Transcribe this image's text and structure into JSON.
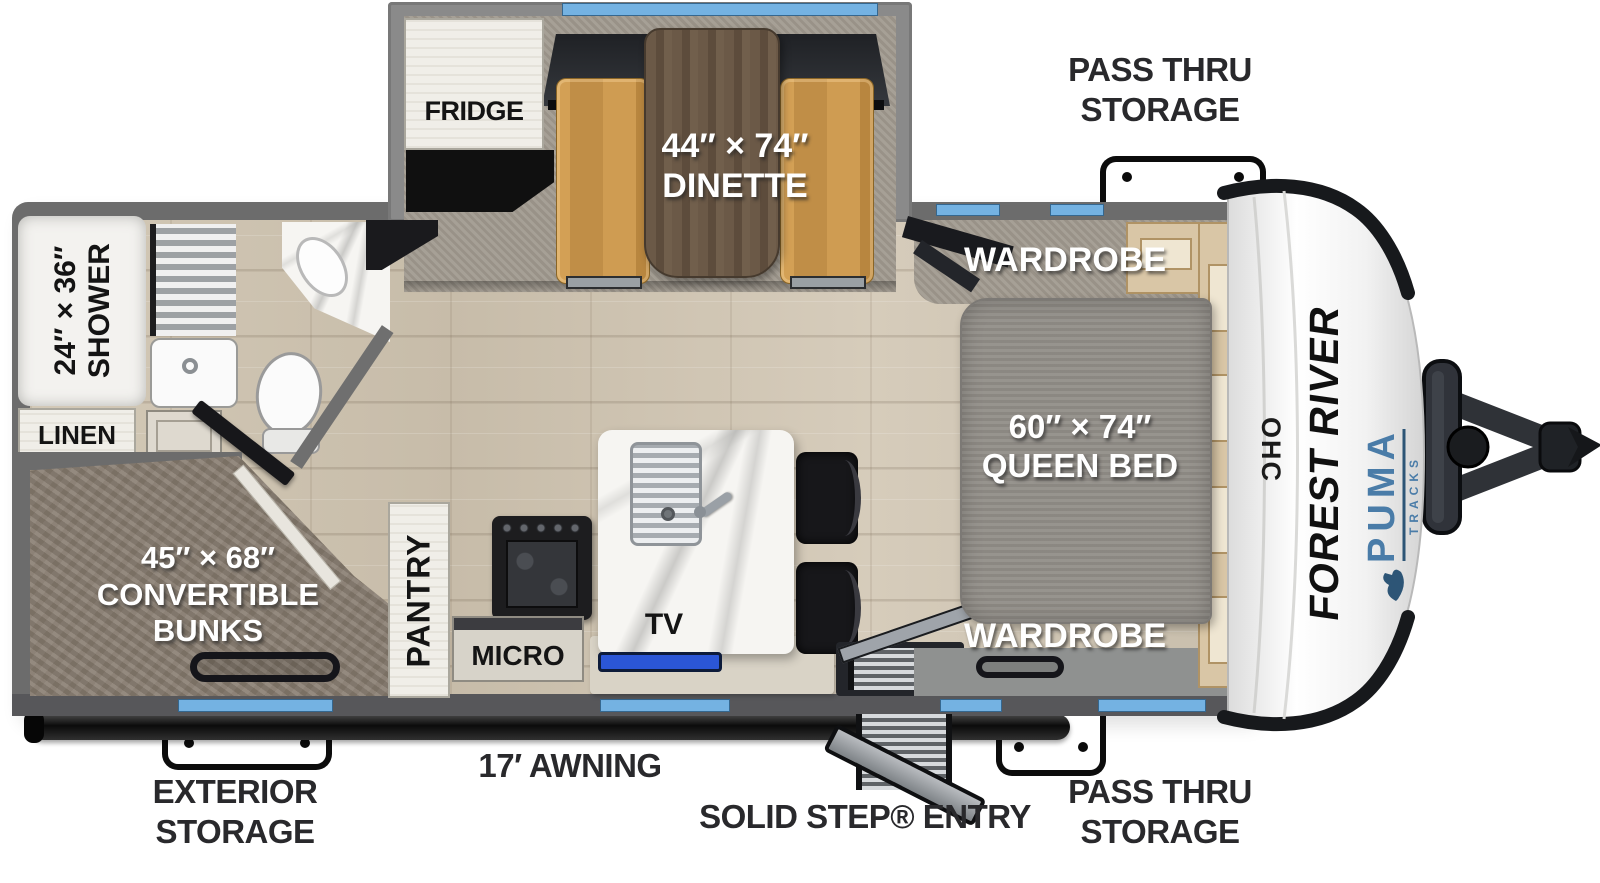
{
  "title": "Puma Tracks travel trailer floor plan",
  "labels": {
    "pass_thru": {
      "line1": "PASS THRU",
      "line2": "STORAGE"
    },
    "exterior": {
      "line1": "EXTERIOR",
      "line2": "STORAGE"
    },
    "awning": "17′ AWNING",
    "entry": "SOLID STEP® ENTRY"
  },
  "rooms": {
    "fridge": "FRIDGE",
    "dinette_size": "44″ × 74″",
    "dinette": "DINETTE",
    "wardrobe_top": "WARDROBE",
    "wardrobe_bottom": "WARDROBE",
    "queen_size": "60″ × 74″",
    "queen": "QUEEN BED",
    "shower_size": "24″ × 36″",
    "shower": "SHOWER",
    "linen": "LINEN",
    "bunks_size": "45″ × 68″",
    "bunks_line2": "CONVERTIBLE",
    "bunks_line3": "BUNKS",
    "pantry": "PANTRY",
    "micro": "MICRO",
    "tv": "TV",
    "ohc": "OHC"
  },
  "branding": {
    "make": "FOREST RIVER",
    "model": "PUMA",
    "model_sub": "TRACKS"
  },
  "colors": {
    "window_blue": "#74b2e2",
    "puma_blue": "#4a7ca8",
    "tv_blue": "#2b56d6",
    "wall_gray": "#6c6c6c"
  }
}
